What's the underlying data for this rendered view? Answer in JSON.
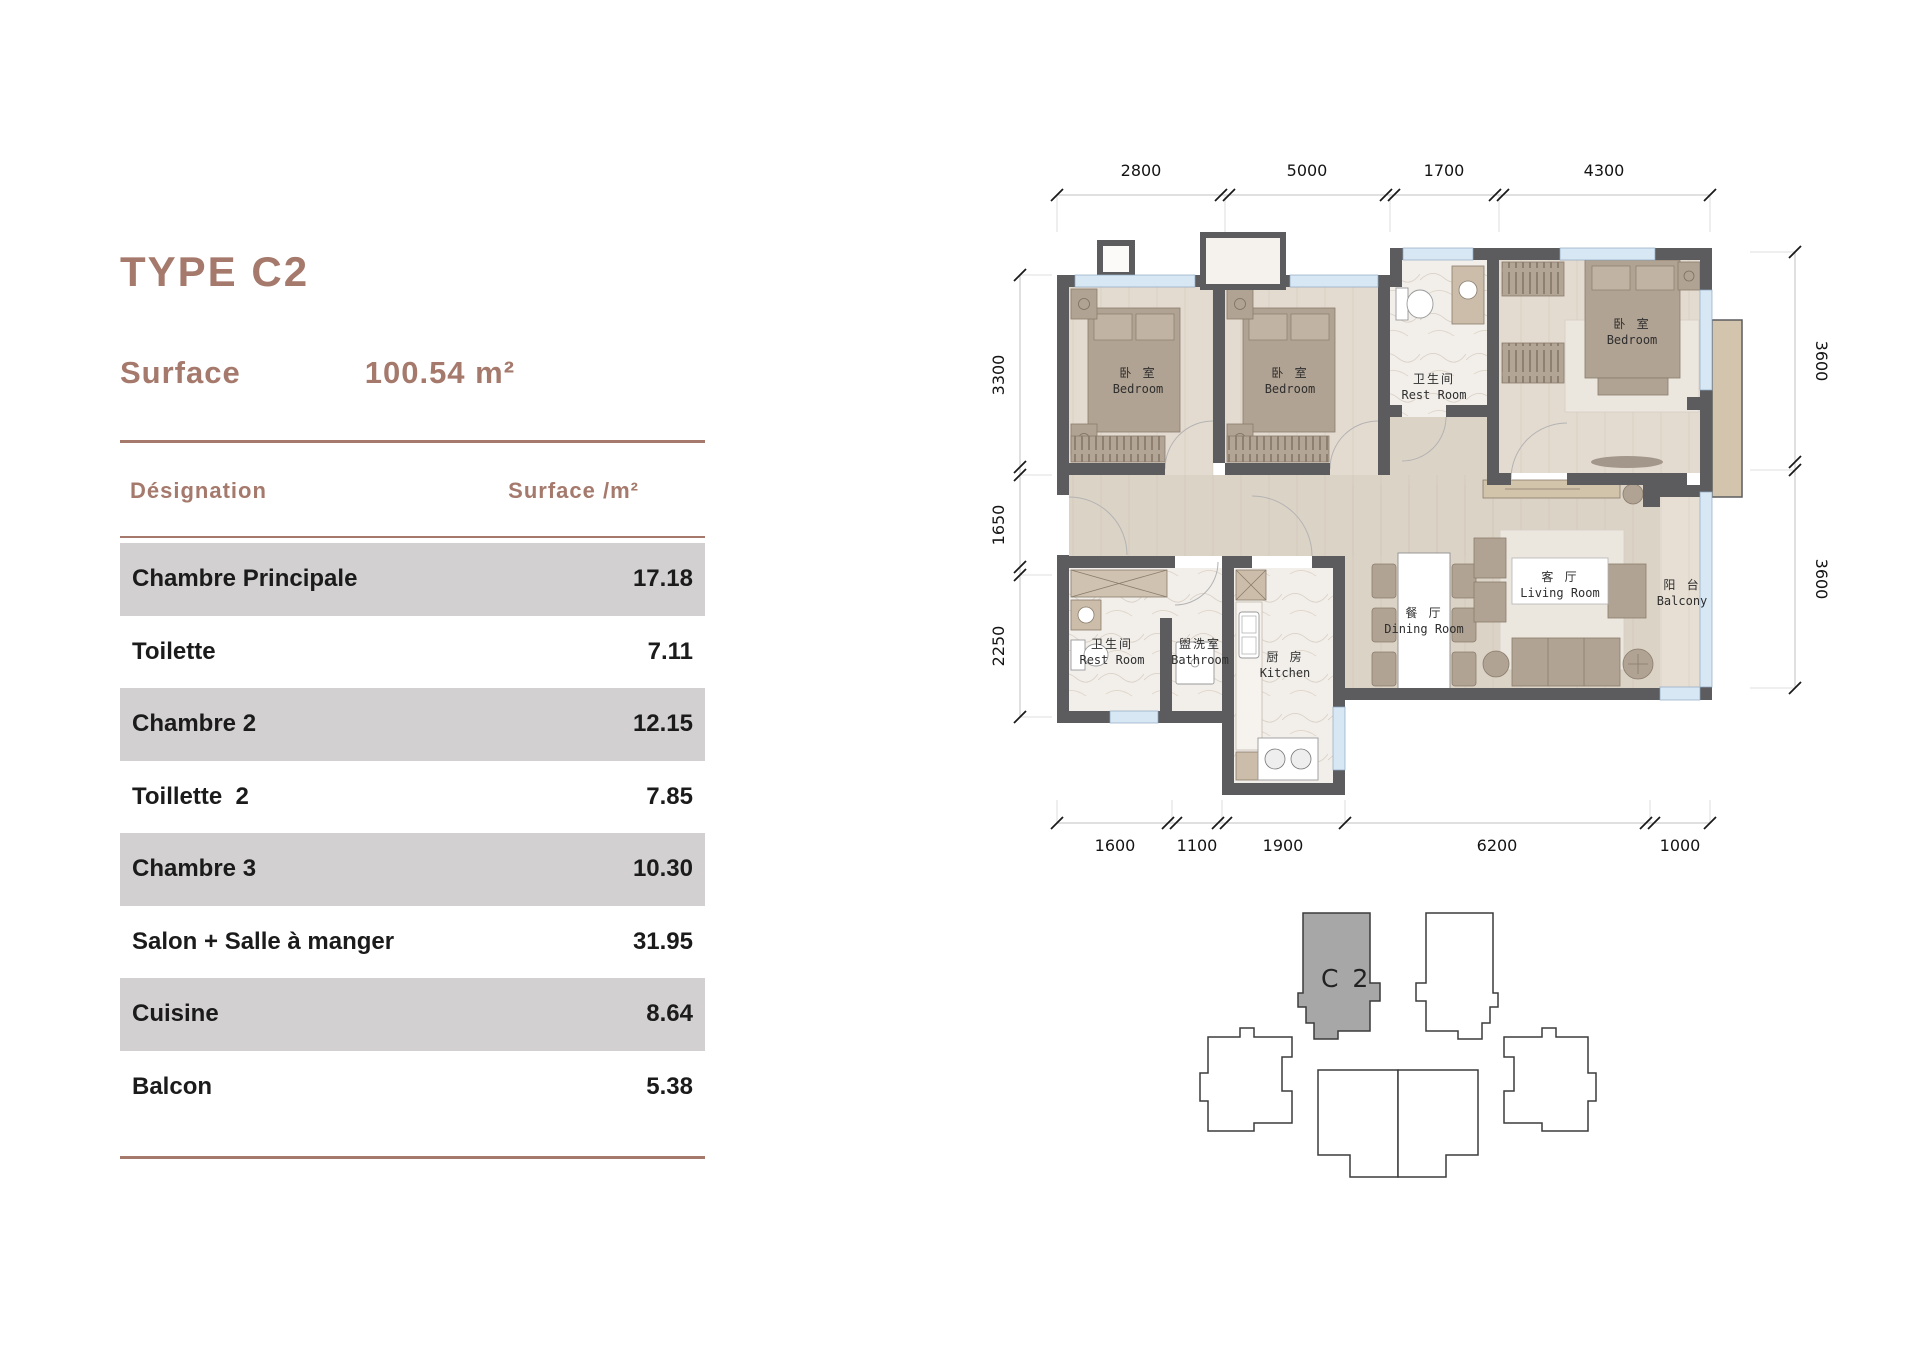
{
  "panel": {
    "title": "TYPE C2",
    "surface_label": "Surface",
    "surface_value": "100.54 m²",
    "table": {
      "col_designation": "Désignation",
      "col_surface": "Surface /m²",
      "rows": [
        {
          "label": "Chambre Principale",
          "value": "17.18"
        },
        {
          "label": "Toilette",
          "value": "7.11"
        },
        {
          "label": "Chambre 2",
          "value": "12.15"
        },
        {
          "label": "Toillette  2",
          "value": "7.85"
        },
        {
          "label": "Chambre 3",
          "value": "10.30"
        },
        {
          "label": "Salon + Salle à manger",
          "value": "31.95"
        },
        {
          "label": "Cuisine",
          "value": "8.64"
        },
        {
          "label": "Balcon",
          "value": "5.38"
        }
      ]
    }
  },
  "plan": {
    "dims_top": [
      "2800",
      "5000",
      "1700",
      "4300"
    ],
    "dims_left": [
      "3300",
      "1650",
      "2250"
    ],
    "dims_right": [
      "3600",
      "3600"
    ],
    "dims_bottom": [
      "1600",
      "1100",
      "1900",
      "6200",
      "1000"
    ],
    "rooms": {
      "bedroom1": {
        "zh": "卧 室",
        "en": "Bedroom"
      },
      "bedroom2": {
        "zh": "卧 室",
        "en": "Bedroom"
      },
      "restroom_top": {
        "zh": "卫生间",
        "en": "Rest Room"
      },
      "master": {
        "zh": "卧 室",
        "en": "Bedroom"
      },
      "restroom2": {
        "zh": "卫生间",
        "en": "Rest Room"
      },
      "bathroom": {
        "zh": "盥洗室",
        "en": "Bathroom"
      },
      "kitchen": {
        "zh": "厨 房",
        "en": "Kitchen"
      },
      "dining": {
        "zh": "餐 厅",
        "en": "Dining Room"
      },
      "living": {
        "zh": "客 厅",
        "en": "Living Room"
      },
      "balcony": {
        "zh": "阳 台",
        "en": "Balcony"
      }
    },
    "key_label": "C 2"
  },
  "colors": {
    "accent_brown": "#a5796c",
    "row_gray": "#d2d0d0",
    "wall": "#5c5c5e",
    "floor": "#dcd3c7",
    "window_blue": "#d7e7f4",
    "key_unit_gray": "#a7a7a7"
  }
}
